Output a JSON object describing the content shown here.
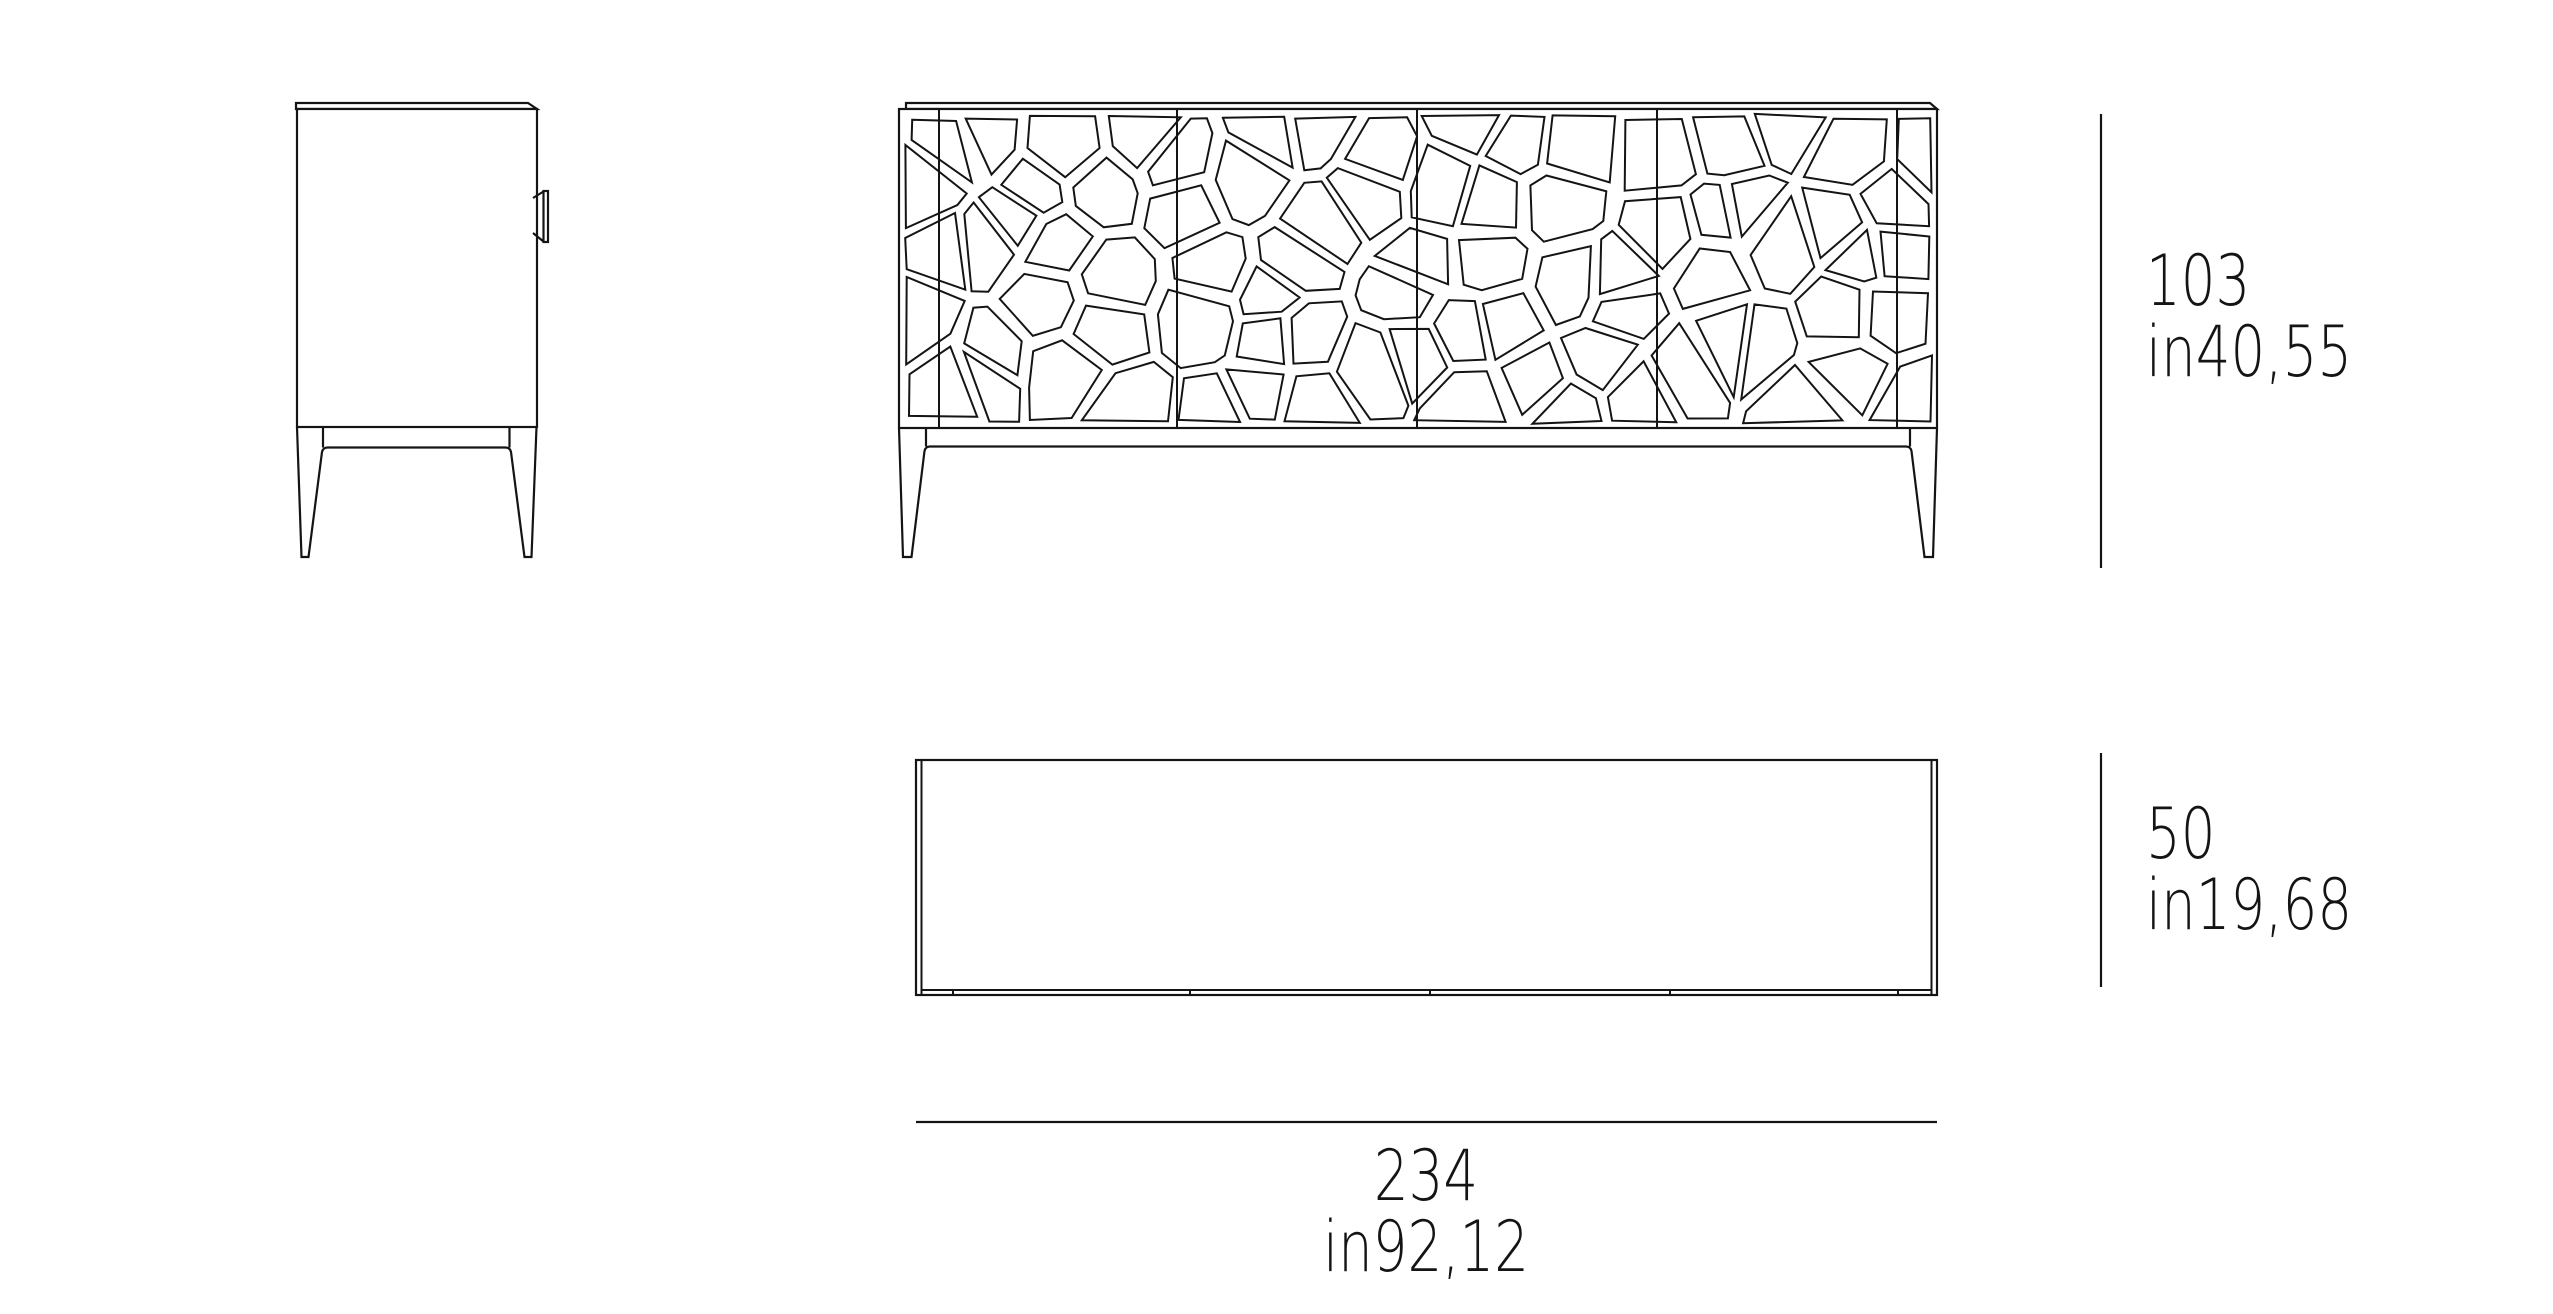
{
  "drawing": {
    "type": "furniture-technical-drawing",
    "views": [
      "side-elevation",
      "front-elevation",
      "plan"
    ]
  },
  "dimensions": {
    "height": {
      "cm": "103",
      "inches": "in40,55"
    },
    "depth": {
      "cm": "50",
      "inches": "in19,68"
    },
    "width": {
      "cm": "234",
      "inches": "in92,12"
    }
  },
  "colors": {
    "line": "#141414",
    "background": "#ffffff"
  }
}
